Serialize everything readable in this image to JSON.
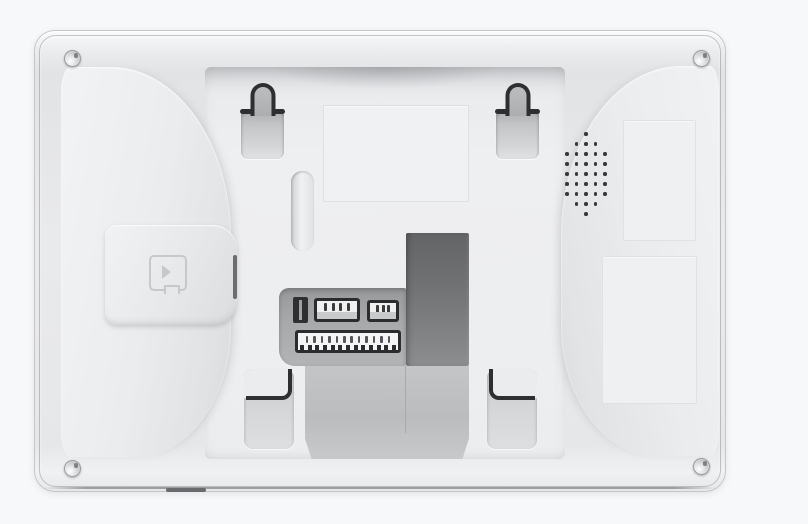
{
  "scene": {
    "type": "product-photo",
    "subject": "Rear housing of a white wall-mount intercom monitor",
    "orientation": "landscape",
    "background_color": "#f7f8f9"
  },
  "colors": {
    "page_background": "#f7f8f9",
    "housing_light": "#f2f3f4",
    "housing_mid": "#e8e9eb",
    "housing_shadow": "#dcdee0",
    "tray": "#edeeef",
    "outline_dark": "#2e2f31",
    "cable_opening_dark": "#6c6e70",
    "connector_shelf": "#a2a4a6",
    "connector_body": "#f0f0f1"
  },
  "device": {
    "screws": [
      "top-left",
      "top-right",
      "bottom-left",
      "bottom-right"
    ],
    "keyholes": [
      "left",
      "right"
    ],
    "hooks": [
      "left",
      "right"
    ],
    "speaker": {
      "dot_rows": [
        1,
        3,
        5,
        5,
        5,
        5,
        5,
        3,
        1
      ]
    },
    "connectors": {
      "bracket_bars": 2,
      "header_a_pins": 4,
      "header_b_pins": 3,
      "long_header_pins": 12,
      "long_header_teeth": 13
    },
    "features": {
      "sd_card_door": true,
      "sd_card_icon": "microsd-card-icon",
      "center_label_recess": true,
      "right_label_plates": 2,
      "bottom_vent_slit": true
    }
  }
}
